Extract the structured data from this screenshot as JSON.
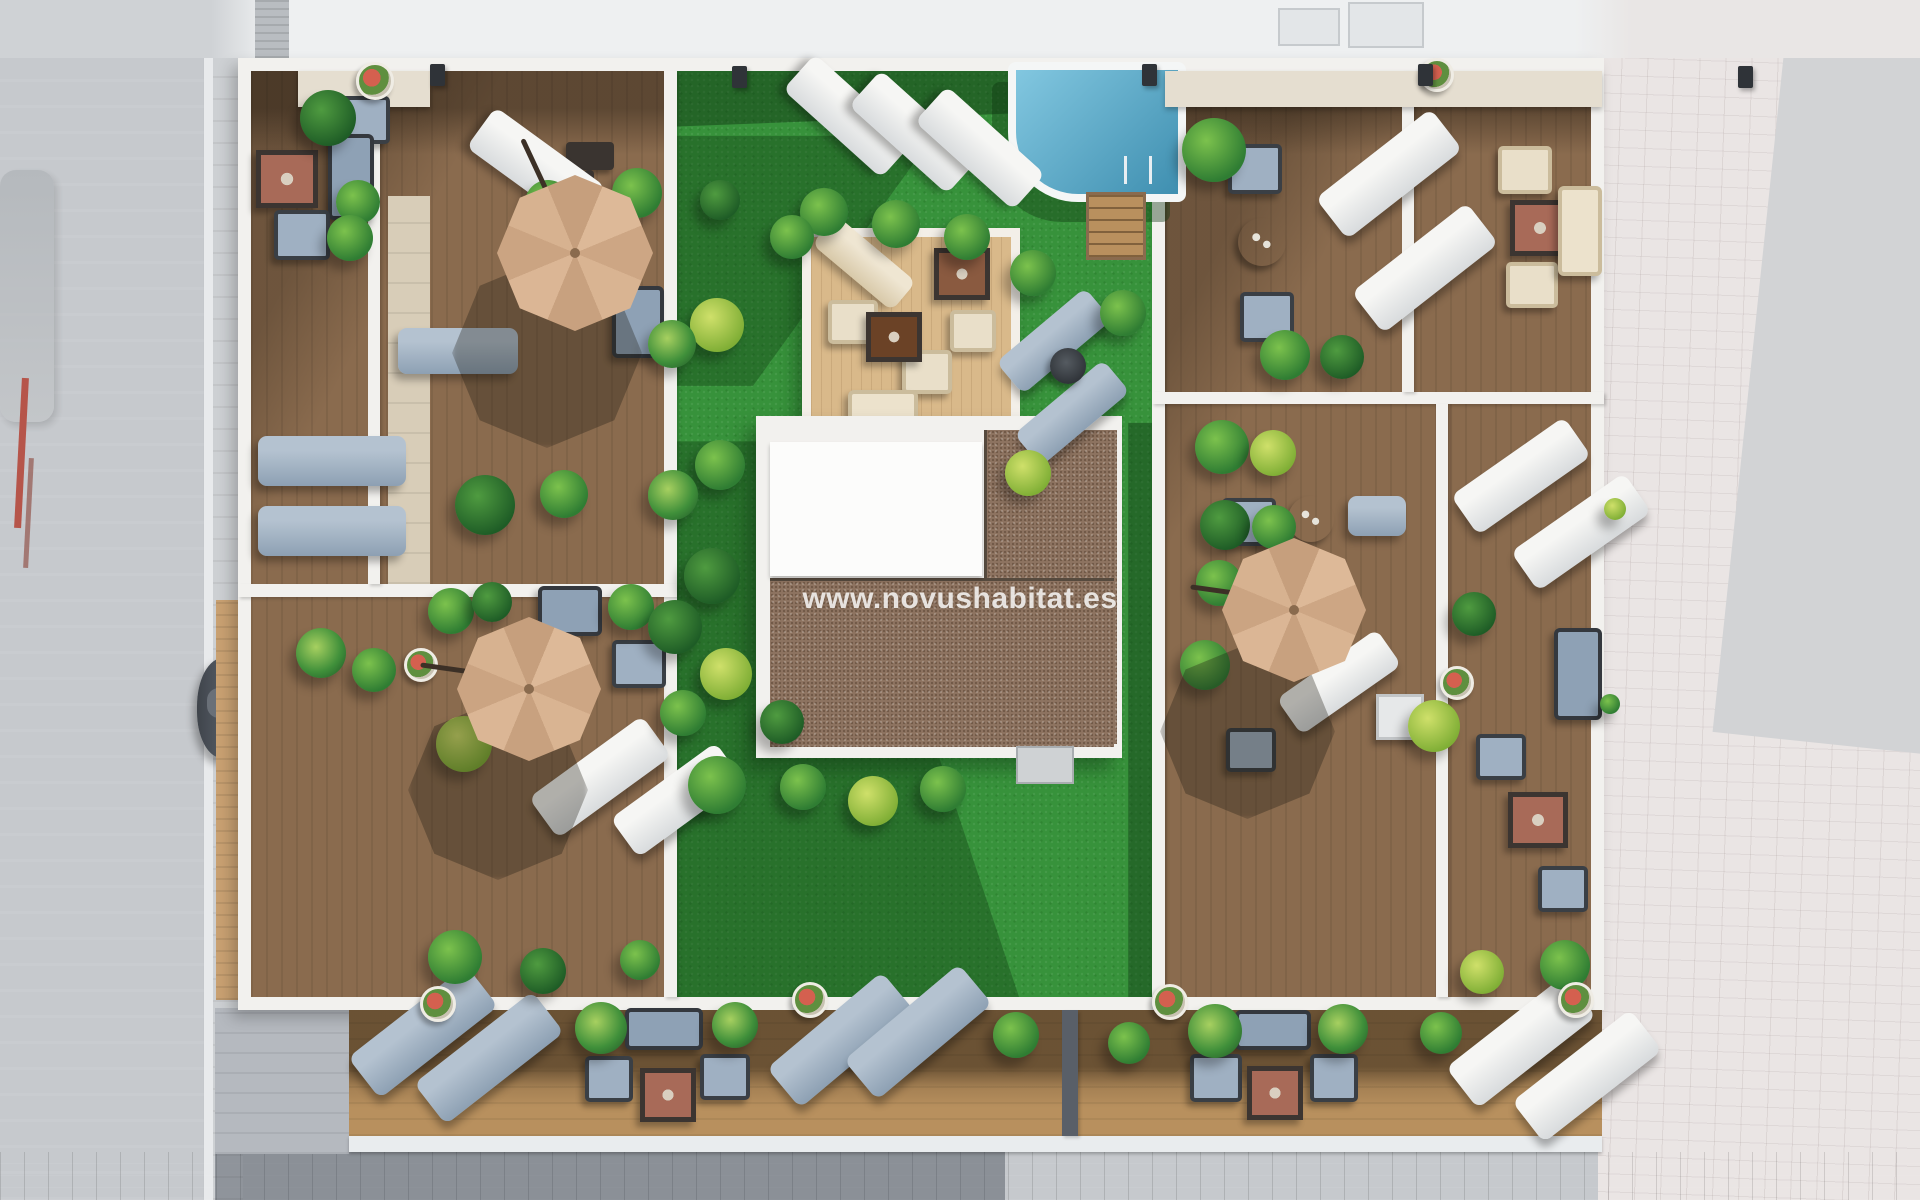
{
  "watermark": {
    "text": "www.novushabitat.es"
  },
  "palette": {
    "grass": "#37923b",
    "grass-dark": "#1e5c28",
    "deck": "#8a6b4e",
    "deck-light": "#b8905e",
    "wall": "#f2f1ee",
    "gravel": "#8d7360",
    "roof-white": "#fcfcfb",
    "pool-light": "#82c7e0",
    "pool-dark": "#3f8fb0",
    "umbrella": "#d8b394",
    "cushion": "#9fb0c2",
    "cream": "#e9dfc9",
    "terracotta": "#a86a58",
    "road": "#c6c9cd",
    "sidewalk": "#eae5e4",
    "platform": "#d9b98a",
    "stone": "#e5ded0"
  },
  "scene": {
    "view": "aerial top-down 3D render of rooftop terraces",
    "umbrella_count": 3,
    "pool_count": 1,
    "car_count": 2,
    "umbrella_color": "tan",
    "watermark_visible": true
  }
}
